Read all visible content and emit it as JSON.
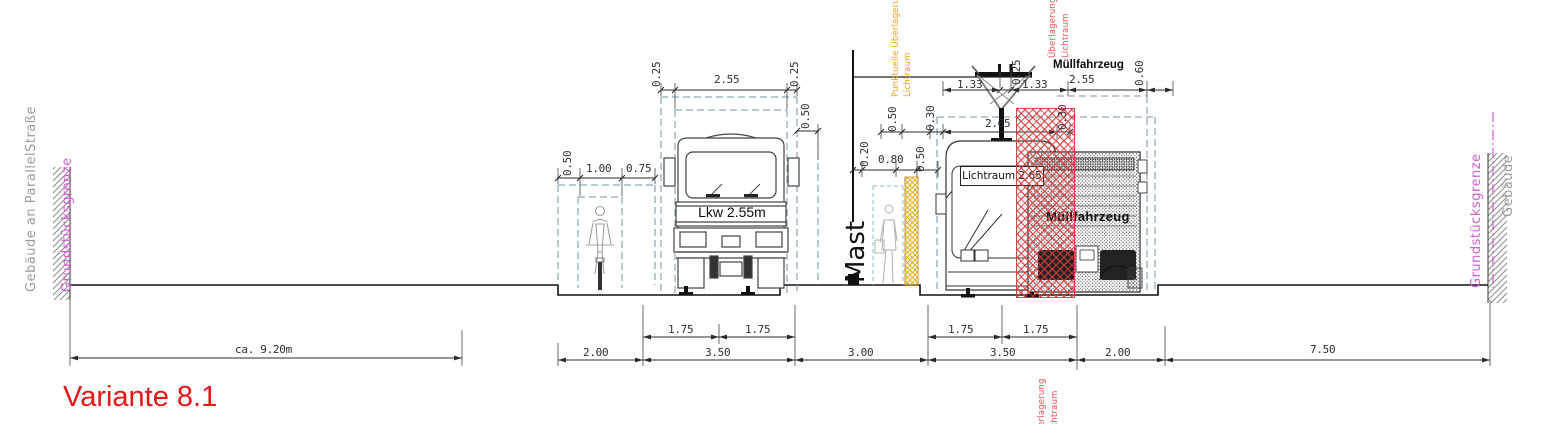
{
  "title": "Variante 8.1",
  "margins": {
    "left_building": "Gebäude an ParallelStraße",
    "left_boundary": "Grundstücksgrenze",
    "right_boundary": "Grundstücksgrenze",
    "right_building": "Gebäude"
  },
  "labels": {
    "mast": "Mast",
    "lkw": "Lkw 2.55m",
    "muellfahrzeug_top": "Müllfahrzeug",
    "muellfahrzeug_body": "Müllfahrzeug",
    "lichtraum_box": "Lichtraum 2.65"
  },
  "overlays": {
    "orange_line1": "Punktuelle Überlagerung",
    "orange_line2": "Lichtraum",
    "red_top_line1": "Überlagerung",
    "red_top_line2": "Lichtraum",
    "red_bottom_line1": "Überlagerung",
    "red_bottom_line2": "Lichtraum"
  },
  "dims": {
    "approach": "ca. 9.20m",
    "lane_aux_left": "2.00",
    "lane_left": "3.50",
    "lane_left_half_a": "1.75",
    "lane_left_half_b": "1.75",
    "median": "3.00",
    "lane_right": "3.50",
    "lane_right_half_a": "1.75",
    "lane_right_half_b": "1.75",
    "lane_aux_right": "2.00",
    "sidewalk_right": "7.50",
    "curb_offset": "0.50",
    "bike_width": "1.00",
    "bike_buffer": "0.75",
    "lkw_margin_left": "0.25",
    "lkw_width": "2.55",
    "lkw_margin_right": "0.25",
    "lkw_side_clearance": "0.50",
    "mast_offset": "0.20",
    "island_walkway": "0.80",
    "island_clearance": "0.50",
    "clearance_upper": "0.50",
    "bus_margin_left": "0.30",
    "bus_clearance_width": "2.65",
    "bus_margin_right": "0.30",
    "wire_left": "1.33",
    "wire_gap": "0.25",
    "wire_right": "1.33",
    "muell_width": "2.55",
    "muell_margin": "0.60"
  },
  "colors": {
    "accent_red": "#e81616",
    "hatch_red": "#d73c3c",
    "hatch_orange": "#e3ac1a",
    "overlay_orange_text": "#e8a11c",
    "overlay_red_text": "#e85050",
    "boundary_magenta": "#d05fd0",
    "building_gray": "#9c9c9c",
    "envelope_blue": "#6f94ab"
  }
}
